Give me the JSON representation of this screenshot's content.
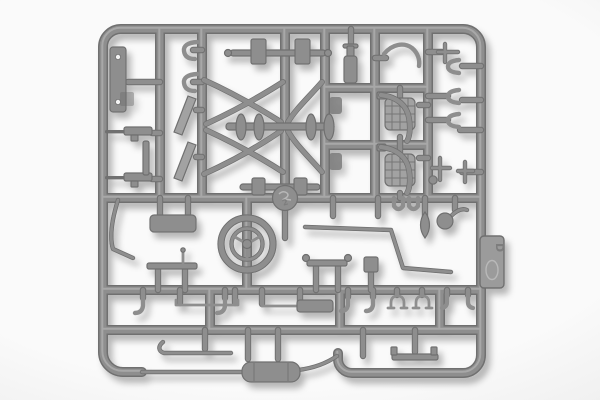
{
  "scene": {
    "subject": "plastic-model-kit-sprue",
    "material": "gray injection-molded styrene on white studio background"
  },
  "sprue": {
    "tab_marking": "D",
    "boss_marking": "2"
  },
  "colors": {
    "bg_outer": "#e3e3e3",
    "bg_inner": "#fafafa",
    "plastic_dark": "#6f6f6f",
    "plastic_mid": "#8e8e8e",
    "plastic_light": "#a2a2a2",
    "plastic_lighter": "#bdbdbd",
    "hole": "#f3f3f3",
    "tab_fill": "#9b9b9b",
    "emboss": "#7d7d7d"
  },
  "parts": [
    {
      "name": "drilled-flat-plate",
      "qty": 1
    },
    {
      "name": "rifle",
      "qty": 2
    },
    {
      "name": "s-hook",
      "qty": 2
    },
    {
      "name": "windshield-blade",
      "qty": 2
    },
    {
      "name": "axle-leaf-spring-assembly",
      "qty": 2
    },
    {
      "name": "radiator-grille",
      "qty": 2
    },
    {
      "name": "fender-strip",
      "qty": 2
    },
    {
      "name": "bottle-shaped-part",
      "qty": 1
    },
    {
      "name": "c-clamp",
      "qty": 3
    },
    {
      "name": "t-bracket",
      "qty": 4
    },
    {
      "name": "steering-wheel",
      "qty": 1
    },
    {
      "name": "center-boss",
      "qty": 1
    },
    {
      "name": "mirror-ball",
      "qty": 1
    },
    {
      "name": "teardrop-lever",
      "qty": 1
    },
    {
      "name": "bent-rod",
      "qty": 3
    },
    {
      "name": "cylinder-block",
      "qty": 1
    },
    {
      "name": "platform-strip",
      "qty": 1
    },
    {
      "name": "tie-rod",
      "qty": 2
    },
    {
      "name": "sleeve-rod",
      "qty": 1
    },
    {
      "name": "hook-peg",
      "qty": 6
    },
    {
      "name": "arch-clamp",
      "qty": 2
    },
    {
      "name": "leaf-spring-bar",
      "qty": 1
    },
    {
      "name": "muffler",
      "qty": 1
    },
    {
      "name": "bottom-bracket",
      "qty": 1
    },
    {
      "name": "id-tab",
      "qty": 1
    }
  ]
}
